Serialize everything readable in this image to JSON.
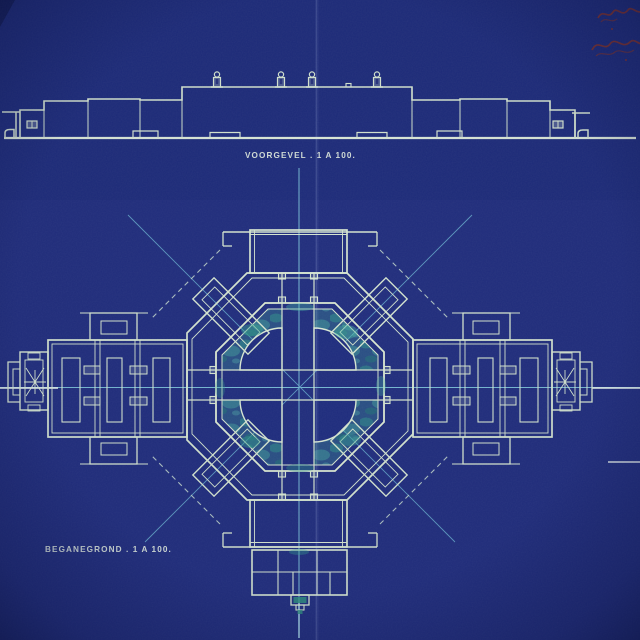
{
  "drawing": {
    "elevation_label": "VOORGEVEL . 1 A 100.",
    "plan_label": "BEGANEGROND . 1 A 100.",
    "handwritten_annotation": "(illegible red handwritten note, cut off at right edge)",
    "roof_figure_count": 4
  },
  "colors": {
    "paper_blue": "#202d7d",
    "paper_edge": "#121b50",
    "line_pale": "#d6e6d0",
    "line_bright": "#ecf5ee",
    "axis_cyan": "#7fc8dc",
    "stain_teal": "#3aa38f",
    "handwriting_red": "#8c3220"
  }
}
